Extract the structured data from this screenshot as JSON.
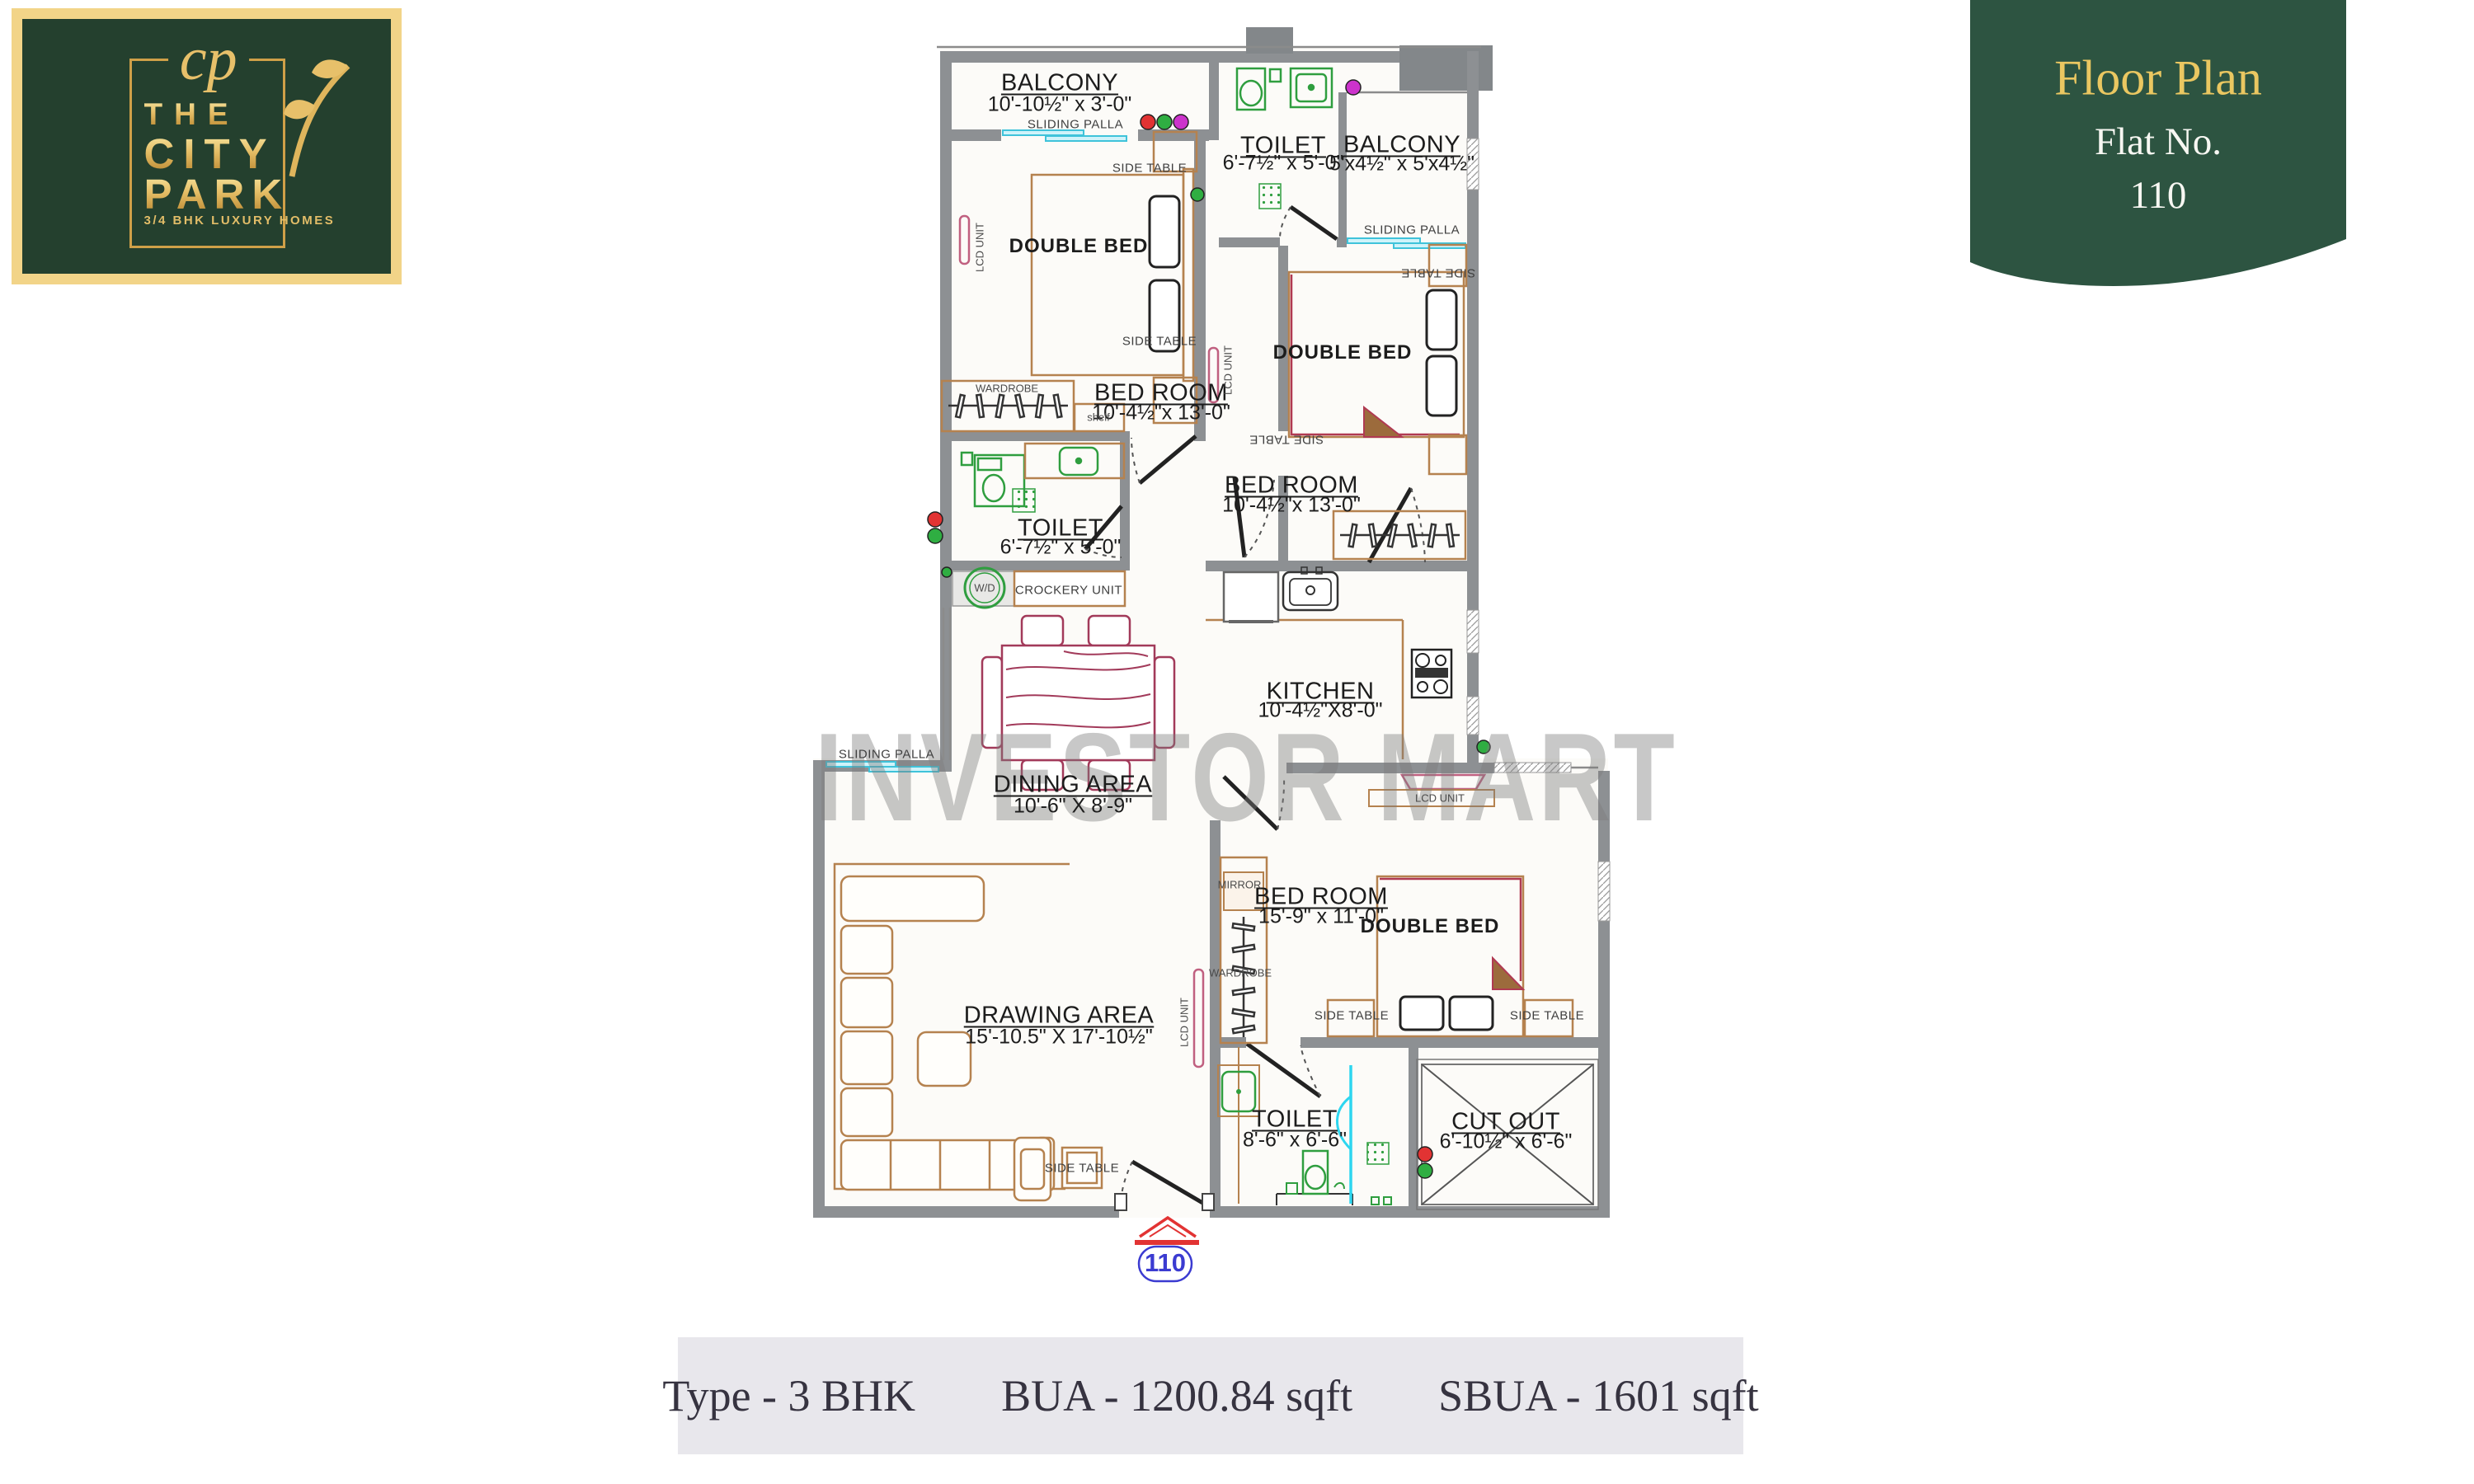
{
  "logo": {
    "monogram": "cp",
    "line1": "THE",
    "line2": "CITY",
    "line3": "PARK",
    "tagline": "3/4 BHK LUXURY HOMES"
  },
  "badge": {
    "title": "Floor Plan",
    "subtitle": "Flat No.",
    "flat_no": "110"
  },
  "watermark": "INVESTOR MART",
  "entrance_flat_no": "110",
  "info_bar": {
    "type": "Type - 3 BHK",
    "bua": "BUA - 1200.84 sqft",
    "sbua": "SBUA - 1601 sqft"
  },
  "rooms": {
    "balcony_top": {
      "name": "BALCONY",
      "dims": "10'-10½\" x 3'-0\""
    },
    "toilet_top": {
      "name": "TOILET",
      "dims": "6'-7½\" x 5'-0\""
    },
    "balcony_right": {
      "name": "BALCONY",
      "dims": "5'x4½\" x 5'x4½\""
    },
    "bedroom_top": {
      "name": "BED ROOM",
      "dims": "10'-4½\"x 13'-0\""
    },
    "bedroom_mid": {
      "name": "BED ROOM",
      "dims": "10'-4½\"x 13'-0\""
    },
    "toilet_mid": {
      "name": "TOILET",
      "dims": "6'-7½\" x 5'-0\""
    },
    "kitchen": {
      "name": "KITCHEN",
      "dims": "10'-4½\"X8'-0\""
    },
    "dining": {
      "name": "DINING AREA",
      "dims": "10'-6\" X 8'-9\""
    },
    "drawing": {
      "name": "DRAWING AREA",
      "dims": "15'-10.5\" X 17'-10½\""
    },
    "bedroom_bottom": {
      "name": "BED ROOM",
      "dims": "15'-9\" x 11'-0\""
    },
    "toilet_bottom": {
      "name": "TOILET",
      "dims": "8'-6\" x 6'-6\""
    },
    "cutout": {
      "name": "CUT OUT",
      "dims": "6'-10½\" x 6'-6\""
    }
  },
  "labels": {
    "double_bed": "DOUBLE BED",
    "side_table": "SIDE TABLE",
    "sliding_palla": "SLIDING PALLA",
    "wardrobe": "WARDROBE",
    "shelf": "shelf",
    "crockery_unit": "CROCKERY UNIT",
    "lcd_unit": "LCD UNIT",
    "mirror": "MIRROR",
    "wd": "W/D"
  },
  "colors": {
    "wall_gray": "#8d9093",
    "fixture_green": "#2f9e3f",
    "window_cyan": "#3fc3da",
    "wood_tan": "#b5824f",
    "dining_maroon": "#a23a5a",
    "lcd_pink": "#c06080",
    "logo_green": "#24402e",
    "badge_green": "#2d5441",
    "gold": "#e5be66",
    "entry_red": "#e23333",
    "entry_blue": "#3b3bd1",
    "bar_separator": "#c8872e"
  }
}
